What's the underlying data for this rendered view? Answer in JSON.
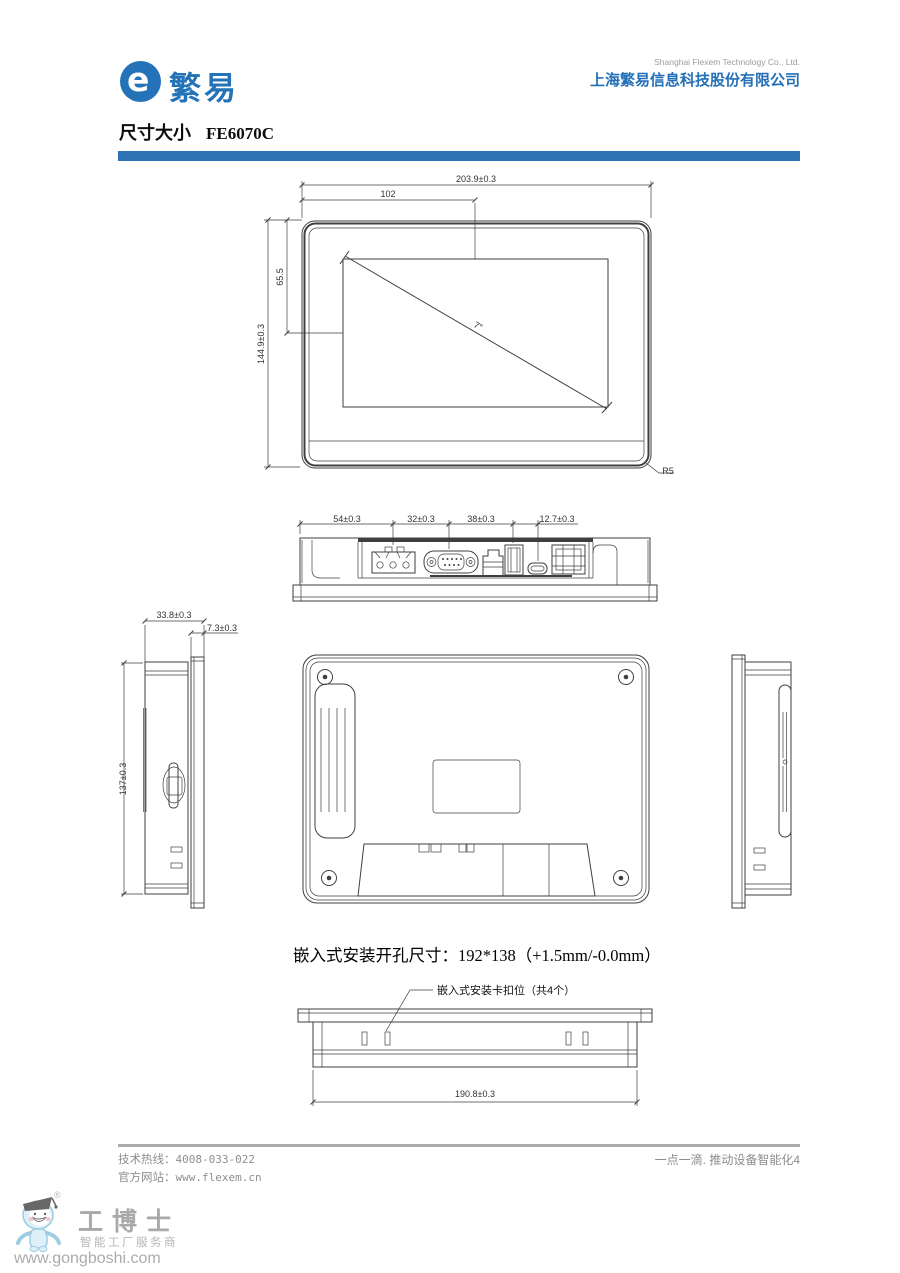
{
  "header": {
    "brand": "繁易",
    "logo_letter": "e",
    "company_en": "Shanghai Flexem Technology Co., Ltd.",
    "company_cn": "上海繁易信息科技股份有限公司"
  },
  "title": {
    "section": "尺寸大小",
    "model": "FE6070C"
  },
  "colors": {
    "brand_blue": "#2472b8",
    "bar_blue": "#2e74b5"
  },
  "drawing": {
    "caption": "嵌入式安装开孔尺寸：192*138（+1.5mm/-0.0mm）",
    "front": {
      "width": "203.9±0.3",
      "screen_offset_x": "102",
      "screen_offset_y": "65.5",
      "height": "144.9±0.3",
      "radius": "R5",
      "diagonal": "7\""
    },
    "bottom": {
      "a": "54±0.3",
      "b": "32±0.3",
      "c": "38±0.3",
      "d": "12.7±0.3"
    },
    "side": {
      "depth": "33.8±0.3",
      "bezel_depth": "7.3±0.3",
      "height": "137±0.3"
    },
    "mount": {
      "width": "190.8±0.3",
      "clip_label": "嵌入式安装卡扣位（共4个）"
    }
  },
  "footer": {
    "hotline_label": "技术热线：",
    "hotline": "4008-033-022",
    "website_label": "官方网站：",
    "website": "www.flexem.cn",
    "slogan": "一点一滴. 推动设备智能化4"
  },
  "watermark": {
    "reg": "®",
    "name": "工博士",
    "tagline": "智能工厂服务商",
    "url": "www.gongboshi.com"
  }
}
